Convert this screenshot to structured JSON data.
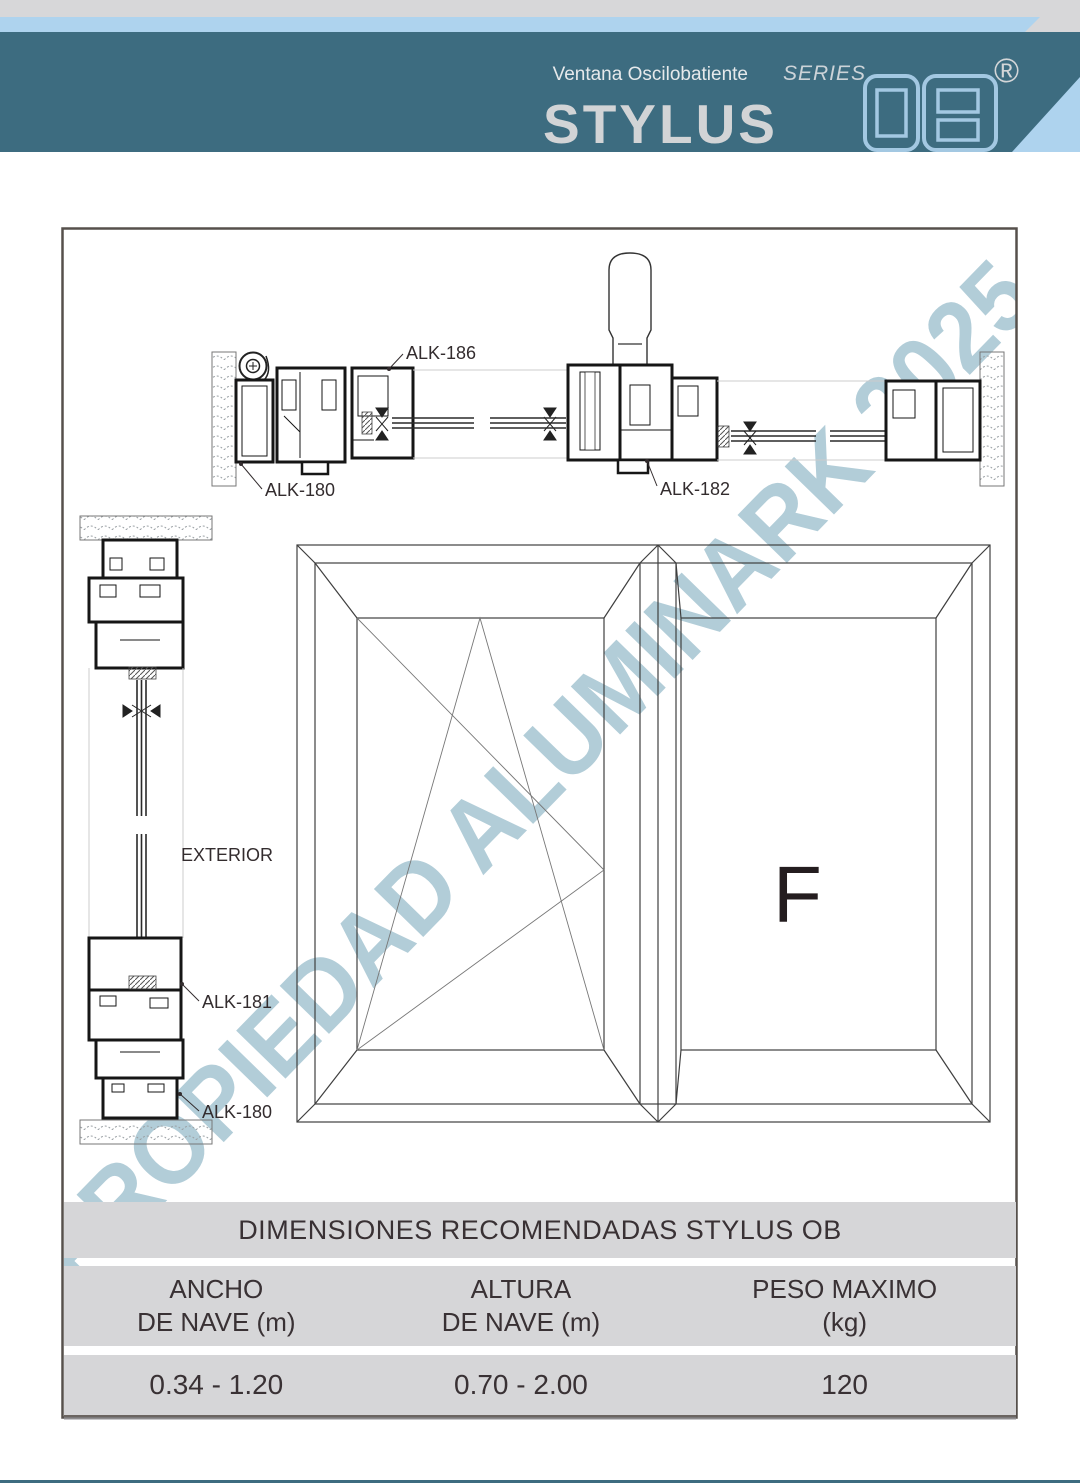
{
  "header": {
    "subtitle": "Ventana Oscilobatiente",
    "title": "STYLUS",
    "series_label": "SERIES",
    "series_code_name": "OB",
    "registered_mark": "®"
  },
  "watermark_text": "PROPIEDAD ALUMINARK 2025",
  "drawing": {
    "section_labels": {
      "alk186": "ALK-186",
      "alk180_plan": "ALK-180",
      "alk182": "ALK-182",
      "exterior": "EXTERIOR",
      "alk181": "ALK-181",
      "alk180_vert": "ALK-180",
      "fixed_pane_letter": "F"
    }
  },
  "table": {
    "title": "DIMENSIONES RECOMENDADAS STYLUS OB",
    "headers": [
      {
        "line1": "ANCHO",
        "line2": "DE NAVE (m)"
      },
      {
        "line1": "ALTURA",
        "line2": "DE NAVE (m)"
      },
      {
        "line1": "PESO MAXIMO",
        "line2": "(kg)"
      }
    ],
    "values": [
      "0.34 - 1.20",
      "0.70 - 2.00",
      "120"
    ]
  },
  "colors": {
    "banner_teal": "#3d6c80",
    "accent_light_blue": "#aed3ee",
    "watermark_blue": "#b2cdd8",
    "table_gray": "#d6d6d8"
  }
}
